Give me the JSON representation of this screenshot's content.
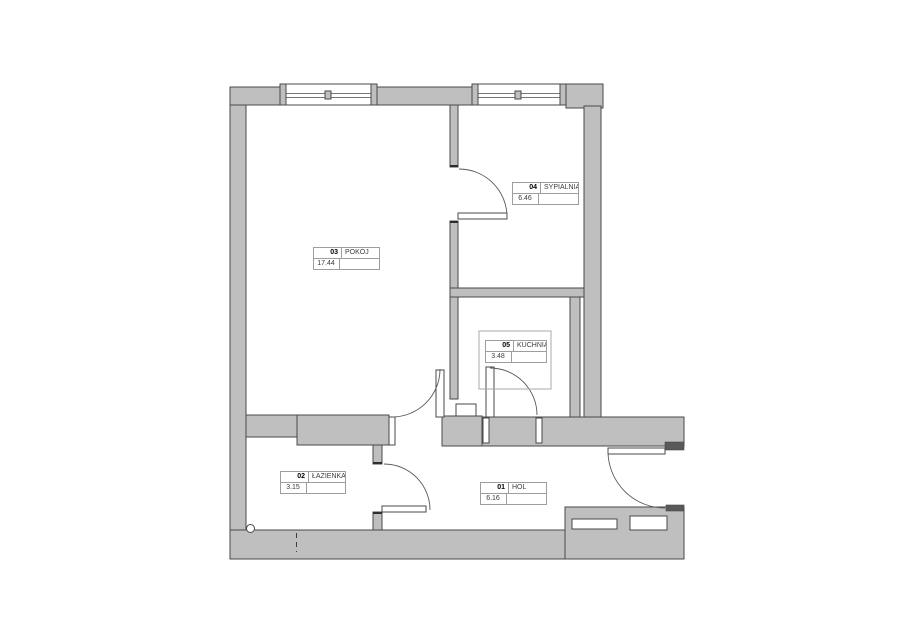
{
  "rooms": [
    {
      "number": "01",
      "name": "HOL",
      "area": "6.16"
    },
    {
      "number": "02",
      "name": "ŁAZIENKA",
      "area": "3.15"
    },
    {
      "number": "03",
      "name": "POKÓJ",
      "area": "17.44"
    },
    {
      "number": "04",
      "name": "SYPIALNIA",
      "area": "6.46"
    },
    {
      "number": "05",
      "name": "KUCHNIA",
      "area": "3.48"
    }
  ],
  "colors": {
    "wall_fill": "#bfbfbf",
    "outline": "#4a4a4a",
    "door_step": "#595959",
    "label_border": "#9e9e9e",
    "label_text": "#3c3c3c",
    "counter_border": "#a8a8a8"
  }
}
